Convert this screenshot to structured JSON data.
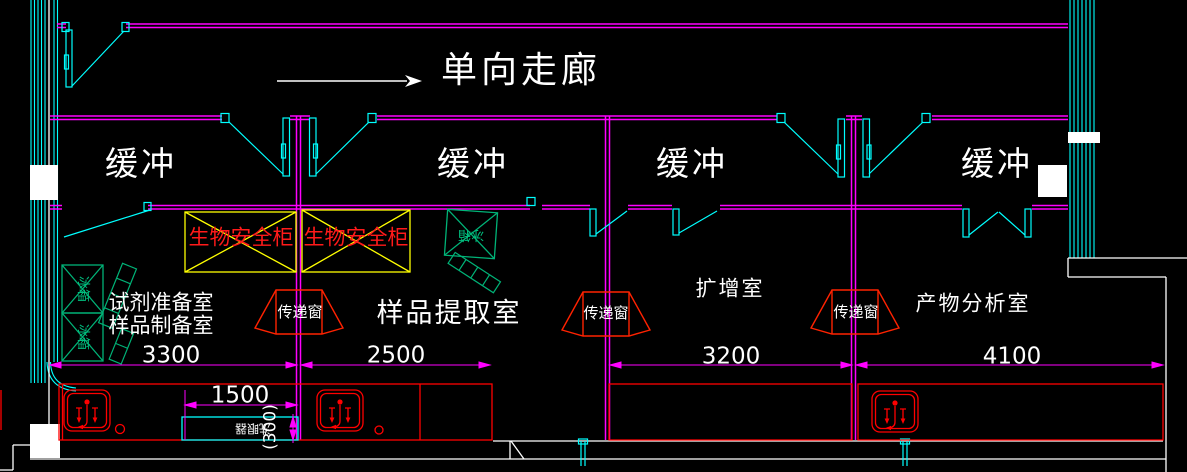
{
  "canvas": {
    "width": 1187,
    "height": 472,
    "background": "#000000"
  },
  "corridor": {
    "label": "单向走廊",
    "direction": "right"
  },
  "buffer": {
    "labels": [
      "缓冲",
      "缓冲",
      "缓冲",
      "缓冲"
    ]
  },
  "rooms": {
    "prep": {
      "line1": "试剂准备室",
      "line2": "样品制备室"
    },
    "extraction": "样品提取室",
    "amplification": "扩增室",
    "analysis": "产物分析室"
  },
  "equipment": {
    "biosafety_cabinet": "生物安全柜",
    "pass_window": "传递窗",
    "fridge": "冰箱",
    "eyewash": "洗眼器"
  },
  "dimensions": {
    "prep_width": "3300",
    "extraction_width": "2500",
    "bench_width": "1500",
    "bench_depth": "(300)",
    "amplification_width": "3200",
    "analysis_width": "4100"
  },
  "colors": {
    "wall": "#ff00ff",
    "door": "#00ffff",
    "annotation": "#ffffff",
    "equipment_green": "#00b377",
    "fixture_red": "#ff0000",
    "cabinet_yellow": "#ffff00"
  }
}
